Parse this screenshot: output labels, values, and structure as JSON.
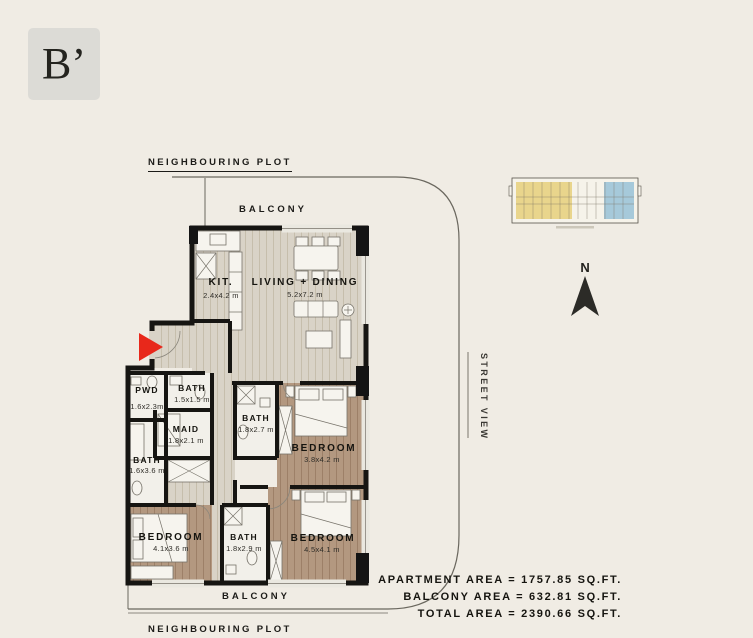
{
  "unit_label": "B’",
  "labels": {
    "neighbouring_plot_top": "NEIGHBOURING PLOT",
    "neighbouring_plot_bottom": "NEIGHBOURING PLOT",
    "balcony_top": "BALCONY",
    "balcony_bottom": "BALCONY",
    "street_view": "STREET VIEW",
    "north": "N"
  },
  "rooms": {
    "kitchen": {
      "name": "KIT.",
      "dim": "2.4x4.2 m"
    },
    "living": {
      "name": "LIVING + DINING",
      "dim": "5.2x7.2 m"
    },
    "pwd": {
      "name": "PWD",
      "dim": "1.6x2.3m"
    },
    "bath_top": {
      "name": "BATH",
      "dim": "1.5x1.5 m"
    },
    "maid": {
      "name": "MAID",
      "dim": "1.8x2.1 m"
    },
    "bath_left": {
      "name": "BATH",
      "dim": "1.6x3.6 m"
    },
    "bath_mid": {
      "name": "BATH",
      "dim": "1.8x2.7 m"
    },
    "bedroom_right_top": {
      "name": "BEDROOM",
      "dim": "3.8x4.2 m"
    },
    "bedroom_left": {
      "name": "BEDROOM",
      "dim": "4.1x3.6 m"
    },
    "bath_bottom": {
      "name": "BATH",
      "dim": "1.8x2.9 m"
    },
    "bedroom_right_bottom": {
      "name": "BEDROOM",
      "dim": "4.5x4.1 m"
    }
  },
  "areas": {
    "apartment": "APARTMENT AREA = 1757.85 SQ.FT.",
    "balcony": "BALCONY AREA = 632.81 SQ.FT.",
    "total": "TOTAL AREA = 2390.66 SQ.FT."
  },
  "colors": {
    "background": "#f0ece4",
    "wall": "#161512",
    "entry_arrow_red": "#e8281b",
    "wood_light_floor": "#d9d3c7",
    "wood_dark_floor": "#b39880",
    "bath_floor": "#f2f0ea",
    "keyplan_yellow": "#e9d58c",
    "keyplan_blue": "#a6c9da"
  }
}
